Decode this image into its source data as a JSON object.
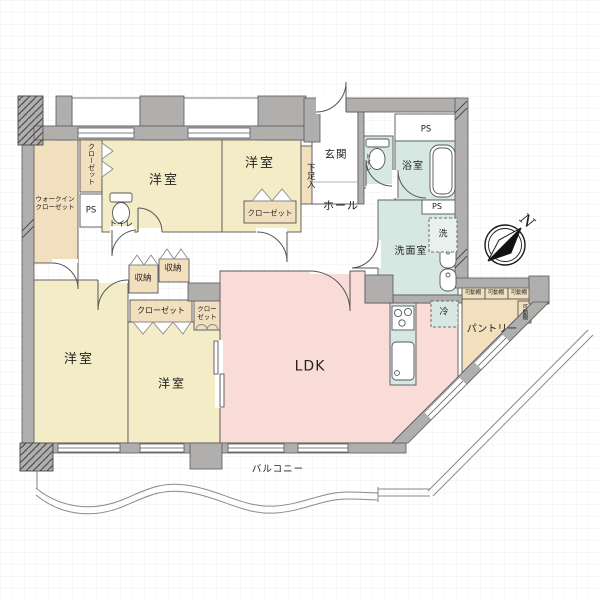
{
  "floorplan": {
    "labels": {
      "walk_in_closet": "ウォークイン\nクローゼット",
      "closet_vertical": "クローゼット",
      "ps_left": "PS",
      "toilet_west": "トイレ",
      "bedroom_top_left": "洋室",
      "bedroom_top_mid": "洋室",
      "closet_top_mid": "クローゼット",
      "shoe_box": "下足入",
      "entrance": "玄関",
      "toilet_entrance": "トイレ",
      "hall": "ホール",
      "ps_top": "PS",
      "bathroom": "浴室",
      "ps_right": "PS",
      "washer": "洗",
      "washroom": "洗面室",
      "storage_1": "収納",
      "storage_2": "収納",
      "closet_mid": "クローゼット",
      "closet_small": "クロー\nゼット",
      "bedroom_bottom_left": "洋室",
      "bedroom_bottom_mid": "洋室",
      "ldk": "LDK",
      "fridge": "冷",
      "pantry": "パントリー",
      "shelf_1": "可動棚",
      "shelf_2": "可動棚",
      "shelf_3": "可動棚",
      "shelf_4": "可動棚",
      "balcony": "バルコニー",
      "compass_north": "N"
    },
    "colors": {
      "bedroom": "#f4ecc6",
      "closet": "#f1dfbd",
      "ldk": "#f9dcd7",
      "wet_area": "#d7e8e2",
      "wall": "#b0afad"
    }
  }
}
